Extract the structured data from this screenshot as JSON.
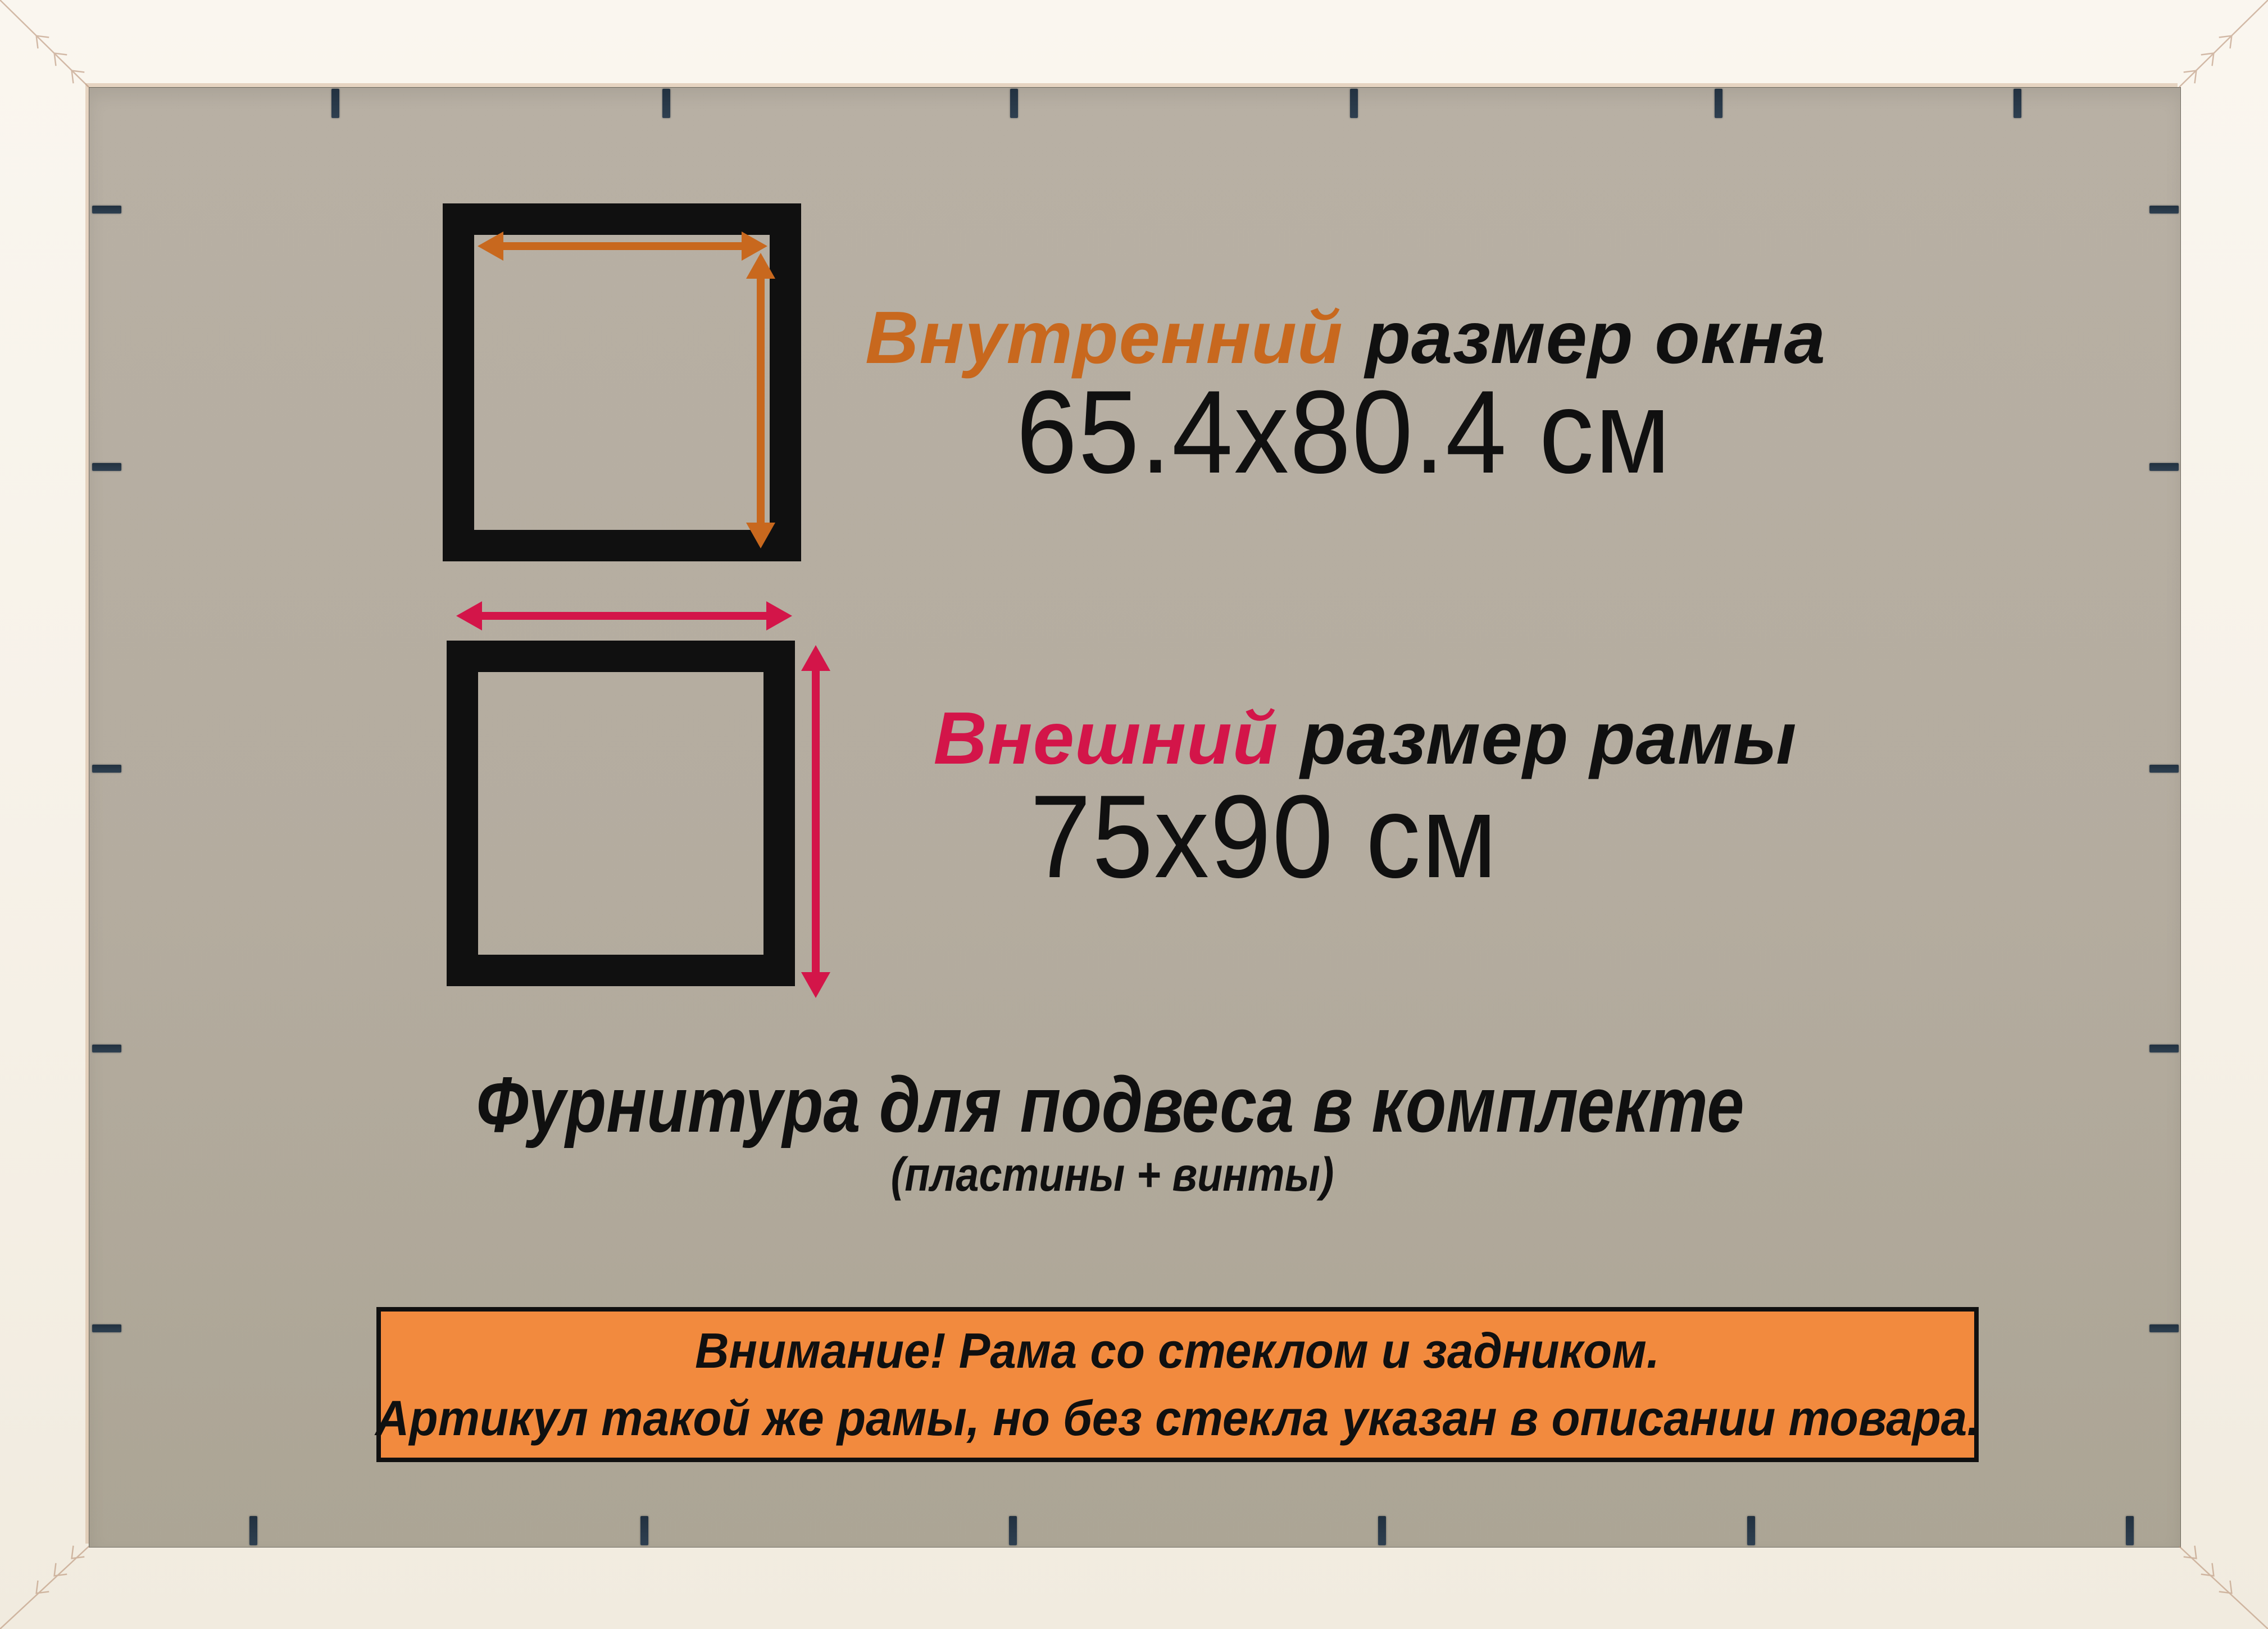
{
  "colors": {
    "frame": "#f7f2e9",
    "backing": "#b4ac9f",
    "ink": "#101010",
    "orange": "#c8681e",
    "crimson": "#d31549",
    "banner": "#f28a3e",
    "staple": "#2c3b49",
    "miter": "#b99277"
  },
  "inner_size": {
    "label_colored": "Внутренний",
    "label_rest": "размер окна",
    "value": "65.4x80.4 см"
  },
  "outer_size": {
    "label_colored": "Внешний",
    "label_rest": "размер рамы",
    "value": "75x90 см"
  },
  "hardware": {
    "line": "Фурнитура для подвеса в комплекте",
    "sub": "(пластины + винты)"
  },
  "banner": {
    "line1": "Внимание! Рама со стеклом и задником.",
    "line2": "Артикул такой же рамы, но без стекла указан в описании товара."
  }
}
